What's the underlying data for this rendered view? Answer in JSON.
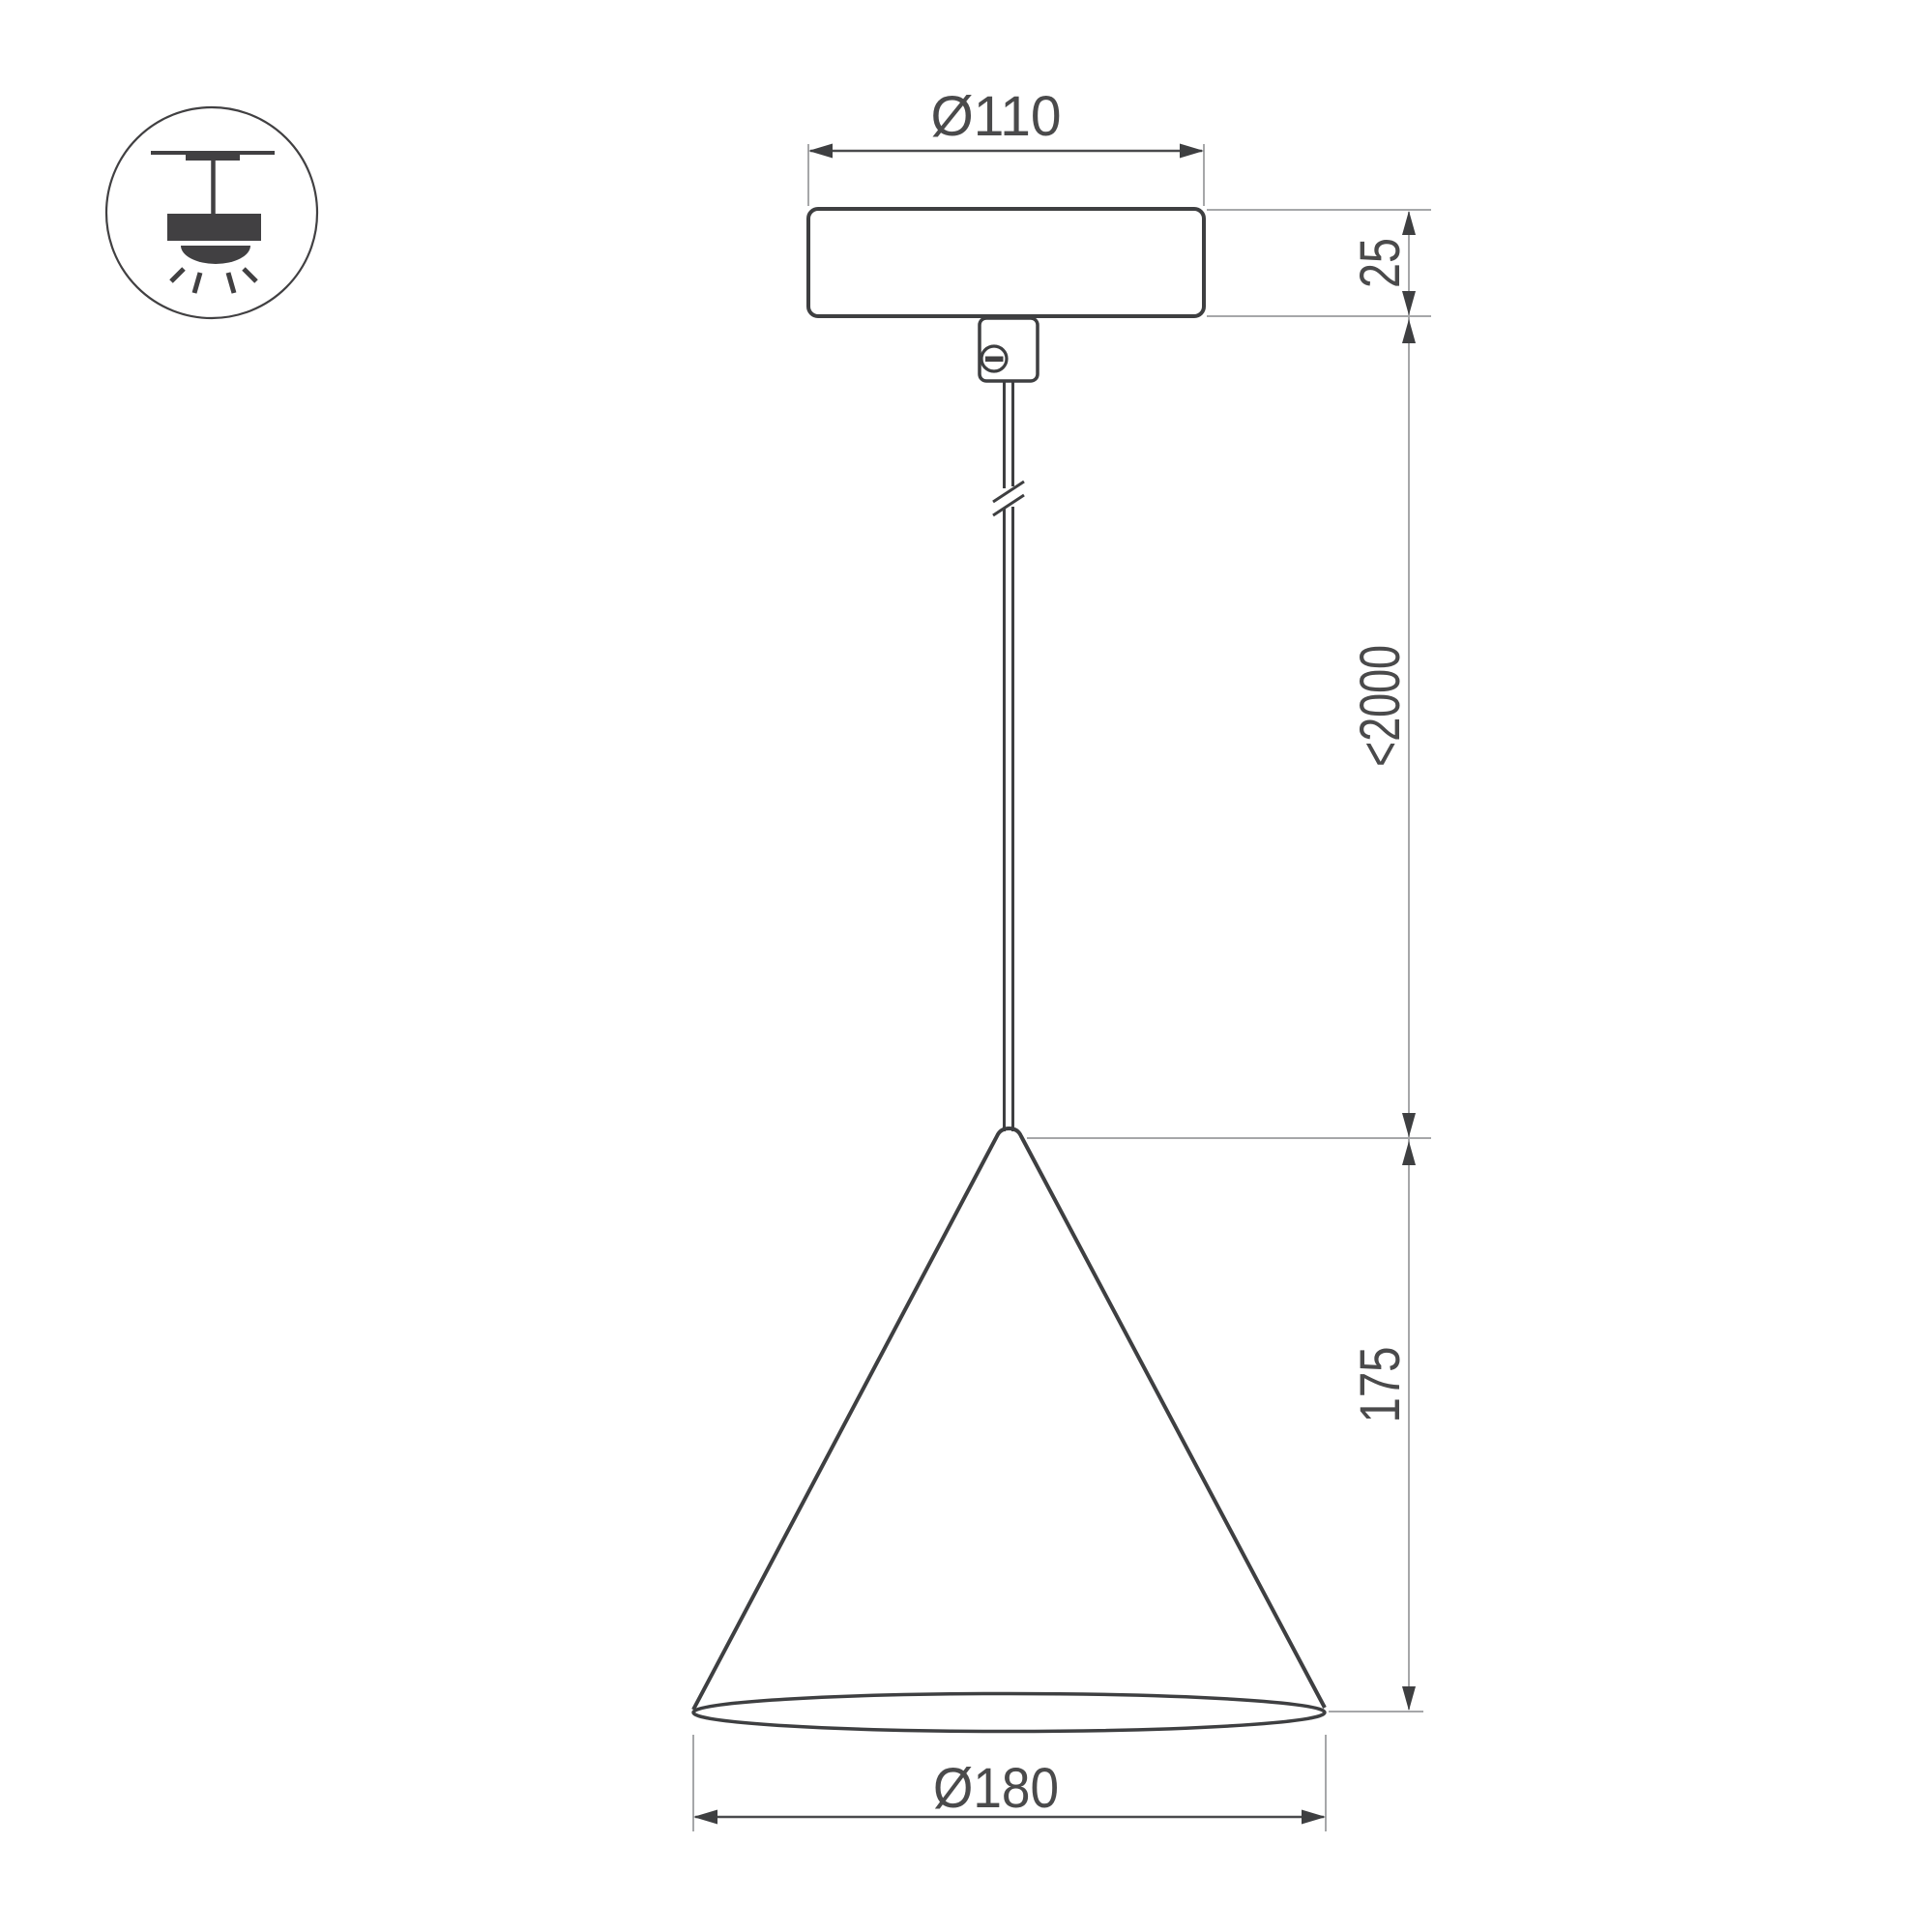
{
  "drawing": {
    "type": "technical-dimension-drawing",
    "subject": "cone pendant luminaire side view",
    "dimensions": {
      "canopy_diameter": "Ø110",
      "canopy_height": "25",
      "suspension_length": "<2000",
      "shade_height": "175",
      "shade_diameter": "Ø180"
    },
    "icon": {
      "name": "pendant-ceiling-light-icon",
      "meaning": "surface ceiling mounted pendant light"
    },
    "colors": {
      "background": "#ffffff",
      "outline": "#3e3f41",
      "dimension_line": "#4a4b4d",
      "extension_line": "#a6a7a9",
      "text": "#4a4a4b",
      "icon_fill": "#414042"
    }
  }
}
